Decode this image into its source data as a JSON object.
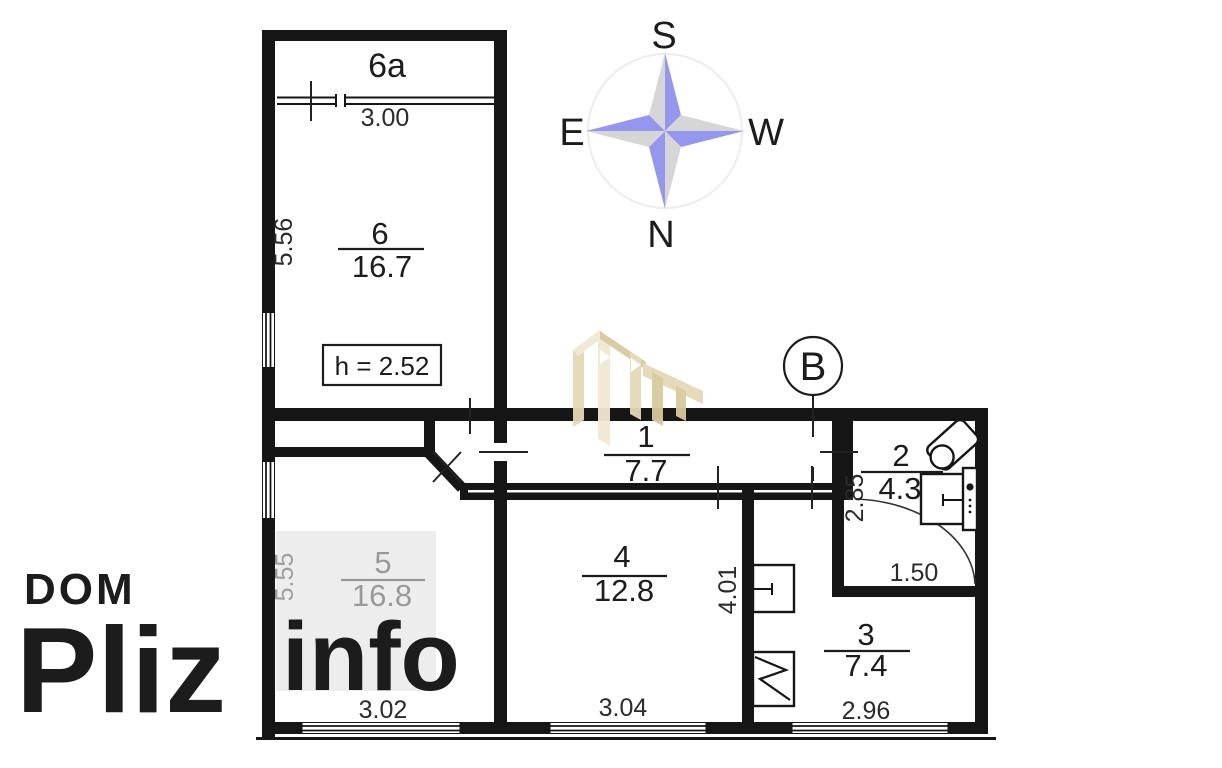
{
  "watermark": {
    "dom": "DOM",
    "pliz": "Pliz",
    "info": "info",
    "dom_color": "#aeaeae",
    "pliz_color": "#e2e2e2",
    "info_color": "#f7f7f7",
    "stamp_color": "rgba(226,226,226,0.63)"
  },
  "compass": {
    "south": "S",
    "east": "E",
    "west": "W",
    "north": "N",
    "blue": "#9597ee",
    "gray": "#d6d6d6",
    "ring": "#ececf2"
  },
  "section_marker": {
    "label": "B"
  },
  "ceiling_height_note": "h = 2.52",
  "logo": {
    "light": "#f0e9d3",
    "mid": "#e4d9b6",
    "dark": "#d8c99e"
  },
  "rooms": {
    "balcony": {
      "number": "6a"
    },
    "r6": {
      "number": "6",
      "area": "16.7"
    },
    "r1": {
      "number": "1",
      "area": "7.7"
    },
    "r2": {
      "number": "2",
      "area": "4.3"
    },
    "r3": {
      "number": "3",
      "area": "7.4"
    },
    "r4": {
      "number": "4",
      "area": "12.8"
    },
    "r5": {
      "number": "5",
      "area": "16.8"
    }
  },
  "dimensions": {
    "balcony_window": "3.00",
    "r6_depth": "5.56",
    "r5_depth": "5.55",
    "r5_width": "3.02",
    "r4_width": "3.04",
    "r4_depth": "4.01",
    "r2_depth": "2.85",
    "r2_width": "1.50",
    "r3_width": "2.96"
  }
}
